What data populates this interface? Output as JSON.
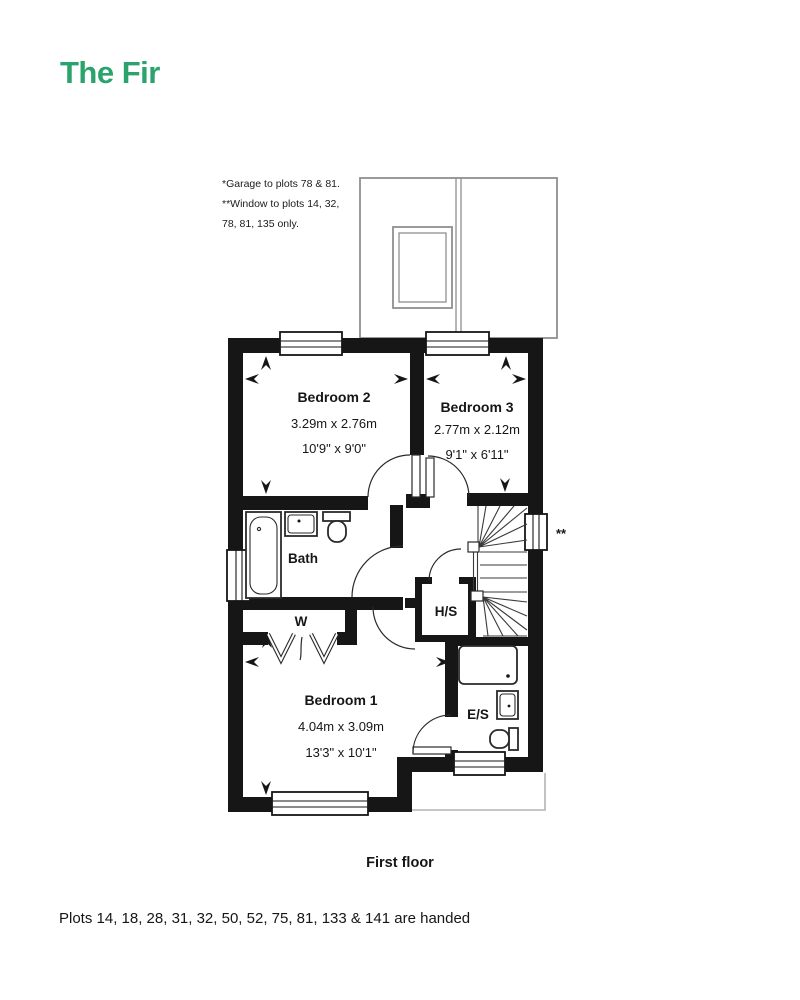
{
  "title": "The Fir",
  "accent_color": "#2BA36D",
  "wall_color": "#161616",
  "garage_line_color": "#8f8f8f",
  "notes": {
    "line1": "*Garage to plots 78 & 81.",
    "line2": "**Window to plots 14, 32,",
    "line3": "78, 81, 135 only."
  },
  "rooms": {
    "bedroom2": {
      "name": "Bedroom 2",
      "metric": "3.29m x 2.76m",
      "imperial": "10'9\" x 9'0\""
    },
    "bedroom3": {
      "name": "Bedroom 3",
      "metric": "2.77m x 2.12m",
      "imperial": "9'1\" x 6'11\""
    },
    "bedroom1": {
      "name": "Bedroom 1",
      "metric": "4.04m x 3.09m",
      "imperial": "13'3\" x 10'1\""
    },
    "bath": {
      "name": "Bath"
    },
    "wardrobe": {
      "name": "W"
    },
    "hs_cupboard": {
      "name": "H/S"
    },
    "ensuite": {
      "name": "E/S"
    }
  },
  "window_marker": "**",
  "caption": "First floor",
  "footer": "Plots 14, 18, 28, 31, 32, 50, 52, 75, 81, 133 & 141 are handed"
}
